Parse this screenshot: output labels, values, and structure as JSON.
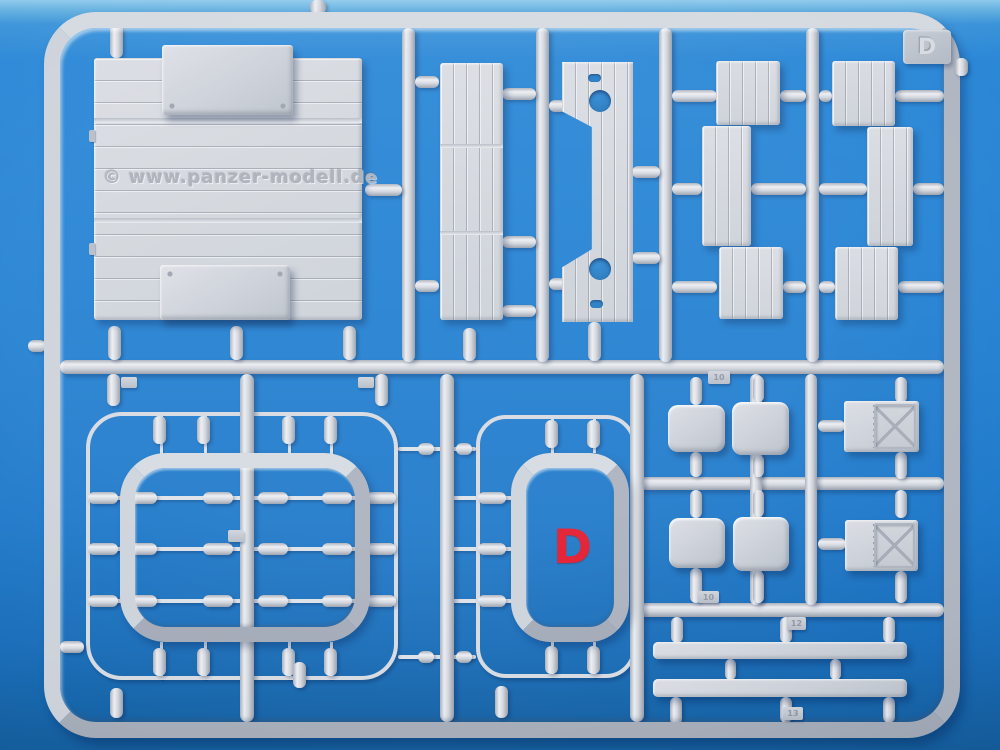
{
  "photo": {
    "watermark": "© www.panzer-modell.de",
    "sprue_label": "D",
    "corner_tab_label": "D",
    "part_number_tabs": [
      "10",
      "10",
      "12",
      "13"
    ]
  },
  "colors": {
    "background_blue": "#2180d2",
    "background_top_band": "#8ec9ec",
    "plastic_base": "#ccd1d9",
    "plastic_highlight": "#eceef2",
    "plastic_shadow": "#99a0ac",
    "annotation_red": "#e2182b"
  }
}
